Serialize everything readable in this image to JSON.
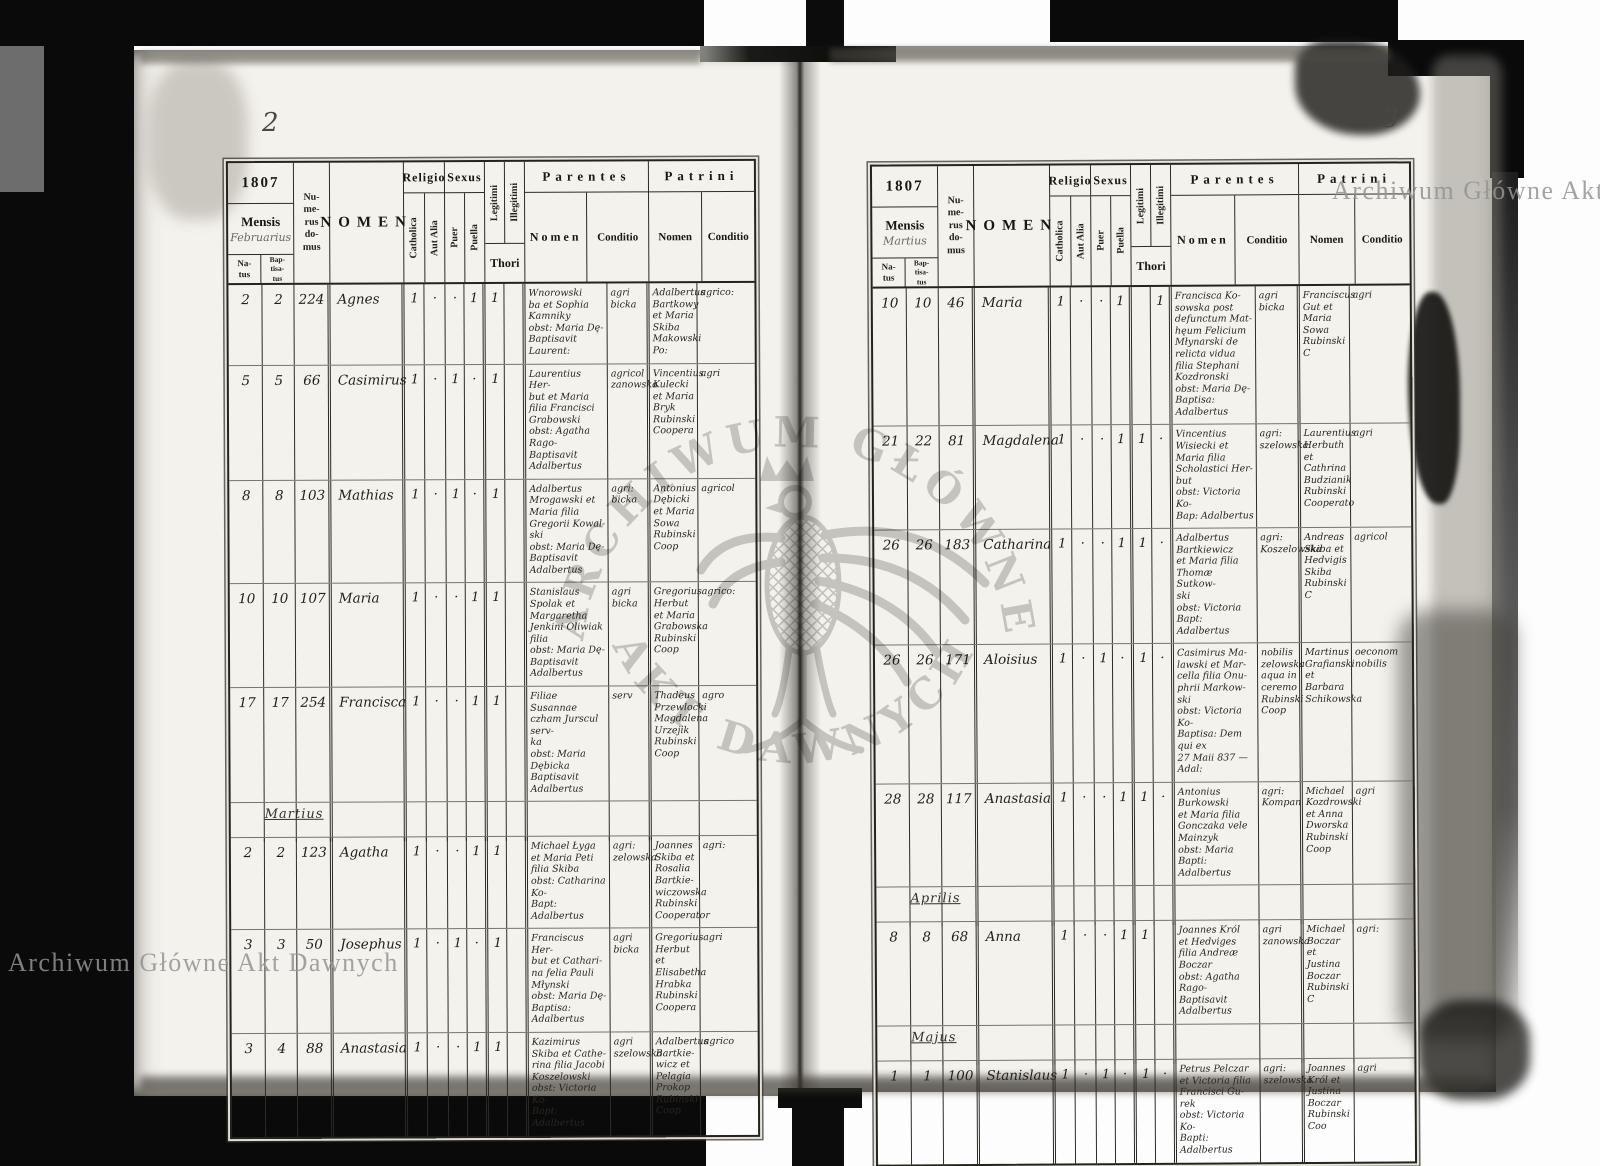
{
  "colors": {
    "cover": "#0a0a0a",
    "paper": "#f4f2ec",
    "ink": "#24211b",
    "wm": "#c7c7c7"
  },
  "watermark": {
    "corner_text": "Archiwum Główne Akt Dawnych",
    "center_arc_top": "ARCHIWUM GŁÓWNE",
    "center_arc_bottom": "AKT DAWNYCH"
  },
  "header_labels": {
    "year": "1807",
    "mensis": "Mensis",
    "natus": "Na-\ntus",
    "baptisatus": "Bap-\ntisa-\ntus",
    "numerus": "Nu-\nme-\nrus\ndo-\nmus",
    "nomen": "NOMEN",
    "religio": "Religio",
    "catholica": "Catholica",
    "aut_alia": "Aut Alia",
    "sexus": "Sexus",
    "puer": "Puer",
    "puella": "Puella",
    "legitimi": "Legitimi",
    "illegitimi": "Illegitimi",
    "thori": "Thori",
    "parentes": "Parentes",
    "patrini": "Patrini",
    "nomen_sub": "Nomen",
    "conditio": "Conditio"
  },
  "left_page": {
    "page_number": "2",
    "mensis_handwritten": "Februarius",
    "rows": [
      {
        "type": "record",
        "natus": "2",
        "baptisatus": "2",
        "domus": "224",
        "nomen": "Agnes",
        "catholica": "1",
        "aut_alia": "·",
        "puer": "·",
        "puella": "1",
        "legitimi": "1",
        "illegitimi": "",
        "parentes_nomen": "Wnorowski\nba et Sophia\nKamniky\nobst: Maria Dę-\nBaptisavit Laurent:",
        "parentes_conditio": "agri\nbicka",
        "patrini_nomen": "Adalbertus\nBartkowy\net Maria\nSkiba\nMakowski Po:",
        "patrini_conditio": "agrico:"
      },
      {
        "type": "record",
        "natus": "5",
        "baptisatus": "5",
        "domus": "66",
        "nomen": "Casimirus",
        "catholica": "1",
        "aut_alia": "·",
        "puer": "1",
        "puella": "·",
        "legitimi": "1",
        "illegitimi": "",
        "parentes_nomen": "Laurentius Her-\nbut et Maria\nfilia Francisci\nGrabowski\nobst: Agatha Rago-\nBaptisavit Adalbertus",
        "parentes_conditio": "agricol\nzanowska",
        "patrini_nomen": "Vincentius\nKulecki\net Maria\nBryk\nRubinski Coopera",
        "patrini_conditio": "agri"
      },
      {
        "type": "record",
        "natus": "8",
        "baptisatus": "8",
        "domus": "103",
        "nomen": "Mathias",
        "catholica": "1",
        "aut_alia": "·",
        "puer": "1",
        "puella": "·",
        "legitimi": "1",
        "illegitimi": "",
        "parentes_nomen": "Adalbertus\nMrogawski et\nMaria filia\nGregorii Kowal-\nski\nobst: Maria Dę-\nBaptisavit Adalbertus",
        "parentes_conditio": "agri:\nbicka",
        "patrini_nomen": "Antonius\nDębicki\net Maria\nSowa\nRubinski Coop",
        "patrini_conditio": "agricol"
      },
      {
        "type": "record",
        "natus": "10",
        "baptisatus": "10",
        "domus": "107",
        "nomen": "Maria",
        "catholica": "1",
        "aut_alia": "·",
        "puer": "·",
        "puella": "1",
        "legitimi": "1",
        "illegitimi": "",
        "parentes_nomen": "Stanislaus\nSpolak et\nMargaretha\nJenkini Oliwiak\nfilia\nobst: Maria Dę-\nBaptisavit Adalbertus",
        "parentes_conditio": "agri\nbicka",
        "patrini_nomen": "Gregorius\nHerbut\net Maria\nGrabowska\nRubinski Coop",
        "patrini_conditio": "agrico:"
      },
      {
        "type": "record",
        "natus": "17",
        "baptisatus": "17",
        "domus": "254",
        "nomen": "Francisca",
        "catholica": "1",
        "aut_alia": "·",
        "puer": "·",
        "puella": "1",
        "legitimi": "1",
        "illegitimi": "",
        "parentes_nomen": "Filiae Susannae\nczham Jurscul serv-\nka\nobst: Maria Dębicka\nBaptisavit Adalbertus",
        "parentes_conditio": "serv",
        "patrini_nomen": "Thadeus\nPrzewlocki\nMagdalena\nUrzejik\nRubinski Coop",
        "patrini_conditio": "agro"
      },
      {
        "type": "section",
        "label": "Martius"
      },
      {
        "type": "record",
        "natus": "2",
        "baptisatus": "2",
        "domus": "123",
        "nomen": "Agatha",
        "catholica": "1",
        "aut_alia": "·",
        "puer": "·",
        "puella": "1",
        "legitimi": "1",
        "illegitimi": "",
        "parentes_nomen": "Michael Łyga\net Maria Peti\nfilia Skiba\nobst: Catharina Ko-\nBapt: Adalbertus",
        "parentes_conditio": "agri:\nzelowska",
        "patrini_nomen": "Joannes\nSkiba et\nRosalia\nBartkie-\nwiczowska\nRubinski Cooperator",
        "patrini_conditio": "agri:"
      },
      {
        "type": "record",
        "natus": "3",
        "baptisatus": "3",
        "domus": "50",
        "nomen": "Josephus",
        "catholica": "1",
        "aut_alia": "·",
        "puer": "1",
        "puella": "·",
        "legitimi": "1",
        "illegitimi": "",
        "parentes_nomen": "Franciscus Her-\nbut et Cathari-\nna felia Pauli\nMłynski\nobst: Maria Dę-\nBaptisa: Adalbertus",
        "parentes_conditio": "agri\nbicka",
        "patrini_nomen": "Gregorius\nHerbut et\nElisabetha\nHrabka\nRubinski Coopera",
        "patrini_conditio": "agri"
      },
      {
        "type": "record",
        "natus": "3",
        "baptisatus": "4",
        "domus": "88",
        "nomen": "Anastasia",
        "catholica": "1",
        "aut_alia": "·",
        "puer": "·",
        "puella": "1",
        "legitimi": "1",
        "illegitimi": "",
        "parentes_nomen": "Kazimirus\nSkiba et Cathe-\nrina filia Jacobi\nKoszelowski\nobst: Victoria Ko-\nBapt: Adalbertus",
        "parentes_conditio": "agri\nszelowska",
        "patrini_nomen": "Adalbertus\nBartkie-\nwicz et\nPelagia\nProkop\nRubinski Coop",
        "patrini_conditio": "agrico"
      }
    ]
  },
  "right_page": {
    "page_number": "3",
    "mensis_handwritten": "Martius",
    "rows": [
      {
        "type": "record",
        "natus": "10",
        "baptisatus": "10",
        "domus": "46",
        "nomen": "Maria",
        "catholica": "1",
        "aut_alia": "·",
        "puer": "·",
        "puella": "1",
        "legitimi": "",
        "illegitimi": "1",
        "parentes_nomen": "Francisca Ko-\nsowska post\ndefunctum Mat-\nhęum Felicium\nMłynarski de\nrelicta vidua\nfilia Stephani\nKozdronski\nobst: Maria Dę-\nBaptisa: Adalbertus",
        "parentes_conditio": "agri\nbicka",
        "patrini_nomen": "Franciscus\nGut et\nMaria\nSowa\nRubinski C",
        "patrini_conditio": "agri"
      },
      {
        "type": "record",
        "natus": "21",
        "baptisatus": "22",
        "domus": "81",
        "nomen": "Magdalena",
        "catholica": "1",
        "aut_alia": "·",
        "puer": "·",
        "puella": "1",
        "legitimi": "1",
        "illegitimi": "·",
        "parentes_nomen": "Vincentius\nWisiecki et\nMaria filia\nScholastici Her-\nbut\nobst: Victoria Ko-\nBap: Adalbertus",
        "parentes_conditio": "agri:\nszelowska",
        "patrini_nomen": "Laurentius\nHerbuth\net Cathrina\nBudzianik\nRubinski Cooperato",
        "patrini_conditio": "agri"
      },
      {
        "type": "record",
        "natus": "26",
        "baptisatus": "26",
        "domus": "183",
        "nomen": "Catharina",
        "catholica": "1",
        "aut_alia": "·",
        "puer": "·",
        "puella": "1",
        "legitimi": "1",
        "illegitimi": "·",
        "parentes_nomen": "Adalbertus\nBartkiewicz\net Maria filia\nThomæ Sutkow-\nski\nobst: Victoria\nBapt: Adalbertus",
        "parentes_conditio": "agri:\nKoszelowska",
        "patrini_nomen": "Andreas\nSkiba et\nHedvigis\nSkiba\nRubinski C",
        "patrini_conditio": "agricol"
      },
      {
        "type": "record",
        "natus": "26",
        "baptisatus": "26",
        "domus": "171",
        "nomen": "Aloisius",
        "catholica": "1",
        "aut_alia": "·",
        "puer": "1",
        "puella": "·",
        "legitimi": "1",
        "illegitimi": "·",
        "parentes_nomen": "Casimirus Ma-\nlawski et Mar-\ncella filia Onu-\nphrii Markow-\nski\nobst: Victoria Ko-\nBaptisa: Dem qui ex\n27 Maii 837 — Adal:",
        "parentes_conditio": "nobilis\nzelowska\naqua in ceremo\nRubinski Coop",
        "patrini_nomen": "Martinus\nGrafianski\net Barbara\nSchikowska",
        "patrini_conditio": "oeconom\nnobilis"
      },
      {
        "type": "record",
        "natus": "28",
        "baptisatus": "28",
        "domus": "117",
        "nomen": "Anastasia",
        "catholica": "1",
        "aut_alia": "·",
        "puer": "·",
        "puella": "1",
        "legitimi": "1",
        "illegitimi": "·",
        "parentes_nomen": "Antonius\nBurkowski\net Maria filia\nGonczaka vele\nMainzyk\nobst: Maria\nBapti: Adalbertus",
        "parentes_conditio": "agri:\nKompan",
        "patrini_nomen": "Michael\nKozdrowski\net Anna\nDworska\nRubinski Coop",
        "patrini_conditio": "agri"
      },
      {
        "type": "section",
        "label": "Aprilis"
      },
      {
        "type": "record",
        "natus": "8",
        "baptisatus": "8",
        "domus": "68",
        "nomen": "Anna",
        "catholica": "1",
        "aut_alia": "·",
        "puer": "·",
        "puella": "1",
        "legitimi": "1",
        "illegitimi": "",
        "parentes_nomen": "Joannes Król\net Hedviges\nfilia Andreæ\nBoczar\nobst: Agatha Rago-\nBaptisavit Adalbertus",
        "parentes_conditio": "agri\nzanowska",
        "patrini_nomen": "Michael\nBoczar et\nJustina\nBoczar\nRubinski C",
        "patrini_conditio": "agri:"
      },
      {
        "type": "section",
        "label": "Majus"
      },
      {
        "type": "record",
        "natus": "1",
        "baptisatus": "1",
        "domus": "100",
        "nomen": "Stanislaus",
        "catholica": "1",
        "aut_alia": "·",
        "puer": "1",
        "puella": "·",
        "legitimi": "1",
        "illegitimi": "·",
        "parentes_nomen": "Petrus Pelczar\net Victoria filia\nFrancisci Gu-\nrek\nobst: Victoria Ko-\nBapti: Adalbertus",
        "parentes_conditio": "agri:\nszelowska",
        "patrini_nomen": "Joannes\nKról et\nJustina\nBoczar\nRubinski Coo",
        "patrini_conditio": "agri"
      }
    ]
  }
}
